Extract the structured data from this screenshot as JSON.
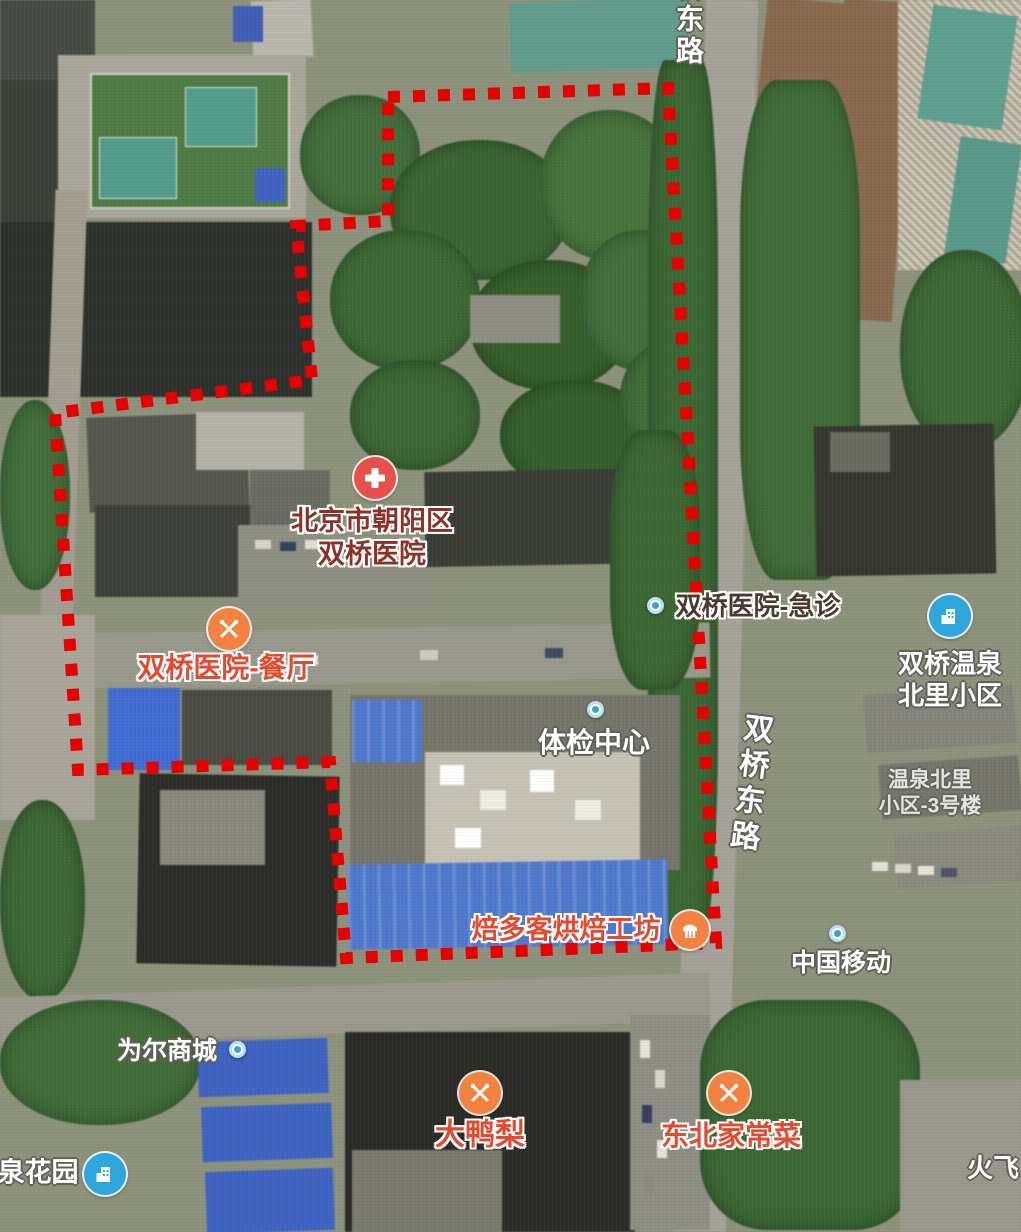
{
  "app": {
    "view": "satellite-map"
  },
  "boundary": {
    "color": "#e60000",
    "style": "dotted-square"
  },
  "roads": [
    {
      "name": "双桥东路"
    },
    {
      "name": "桥东路"
    }
  ],
  "pois": [
    {
      "id": "hospital",
      "icon": "red-cross-icon",
      "line1": "北京市朝阳区",
      "line2": "双桥医院"
    },
    {
      "id": "hospital-canteen",
      "icon": "restaurant-icon",
      "name": "双桥医院-餐厅"
    },
    {
      "id": "hospital-emergency",
      "icon": "place-dot-icon",
      "name": "双桥医院-急诊"
    },
    {
      "id": "exam-center",
      "icon": "place-dot-icon",
      "name": "体检中心"
    },
    {
      "id": "hotspring-north-community",
      "icon": "residential-icon",
      "line1": "双桥温泉",
      "line2": "北里小区"
    },
    {
      "id": "hotspring-north-building-3",
      "icon": "none",
      "line1": "温泉北里",
      "line2": "小区-3号楼"
    },
    {
      "id": "beiduoke-bakery",
      "icon": "bakery-icon",
      "name": "焙多客烘焙工坊"
    },
    {
      "id": "china-mobile",
      "icon": "place-dot-icon",
      "name": "中国移动"
    },
    {
      "id": "weier-mall",
      "icon": "place-dot-icon",
      "name": "为尔商城"
    },
    {
      "id": "dayali",
      "icon": "restaurant-icon",
      "name": "大鸭梨"
    },
    {
      "id": "dongbei-homestyle",
      "icon": "restaurant-icon",
      "name": "东北家常菜"
    },
    {
      "id": "spring-garden",
      "icon": "residential-icon",
      "name": "泉花园"
    },
    {
      "id": "huofei",
      "icon": "none",
      "name": "火飞"
    }
  ],
  "colors": {
    "boundary_red": "#e60000",
    "poi_orange": "#f2823f",
    "poi_red": "#e8504d",
    "poi_blue": "#2ea7dc",
    "label_orange": "#e44a2e",
    "label_dark_red": "#8d3126",
    "label_white": "#ffffff"
  }
}
